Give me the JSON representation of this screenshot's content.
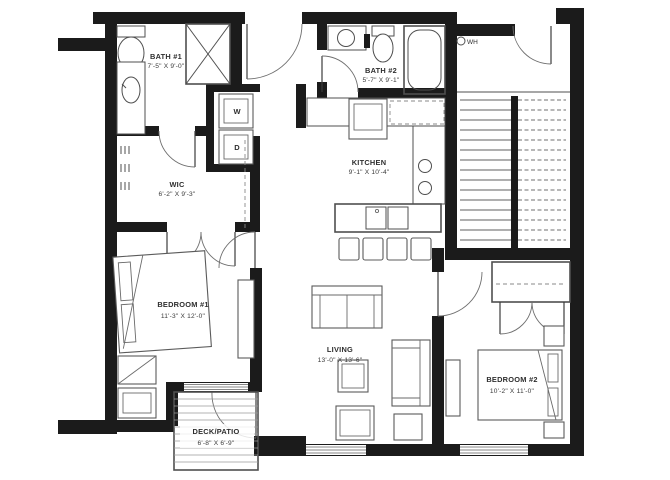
{
  "colors": {
    "wall": "#1b1b1b",
    "line": "#4f4f4f",
    "background": "#ffffff"
  },
  "rooms": {
    "bath1": {
      "name": "BATH #1",
      "dims": "7'-5\" X 9'-0\""
    },
    "bath2": {
      "name": "BATH #2",
      "dims": "5'-7\" X 9'-1\""
    },
    "wic": {
      "name": "WIC",
      "dims": "6'-2\" X 9'-3\""
    },
    "kitchen": {
      "name": "KITCHEN",
      "dims": "9'-1\" X 10'-4\""
    },
    "bedroom1": {
      "name": "BEDROOM #1",
      "dims": "11'-3\" X 12'-0\""
    },
    "living": {
      "name": "LIVING",
      "dims": "13'-0\" X 13'-6\""
    },
    "bedroom2": {
      "name": "BEDROOM #2",
      "dims": "10'-2\" X 11'-0\""
    },
    "deck": {
      "name": "DECK/PATIO",
      "dims": "6'-8\" X 6'-9\""
    }
  },
  "appliances": {
    "washer": "W",
    "dryer": "D",
    "water_heater": "WH"
  }
}
